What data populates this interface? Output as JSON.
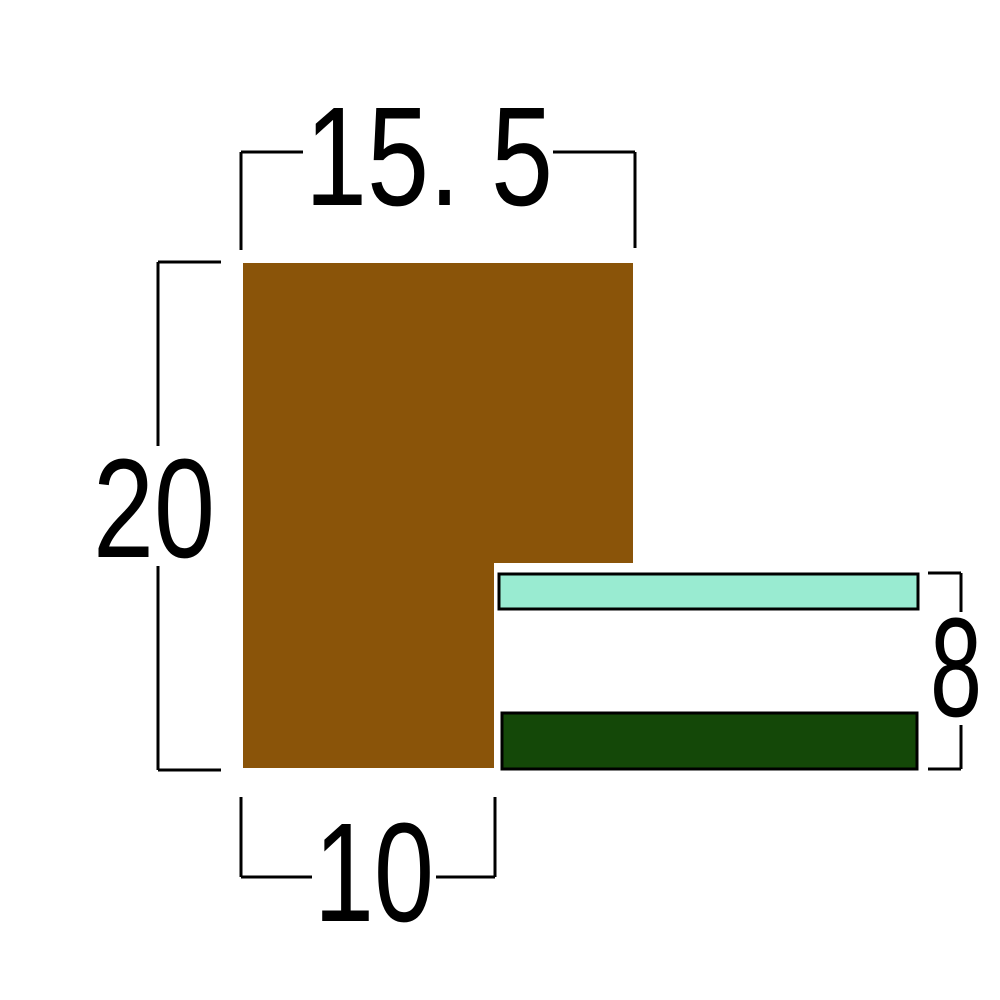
{
  "colors": {
    "background": "#FFFFFF",
    "line": "#000000",
    "moulding": "#8A5409",
    "liner": "#99EBD1",
    "rabbet": "#144808"
  },
  "dimensions": {
    "top_width": {
      "label": "15. 5",
      "value": 15.5
    },
    "left_height": {
      "label": "20",
      "value": 20
    },
    "bottom_width": {
      "label": "10",
      "value": 10
    },
    "right_height": {
      "label": "8",
      "value": 8
    }
  }
}
